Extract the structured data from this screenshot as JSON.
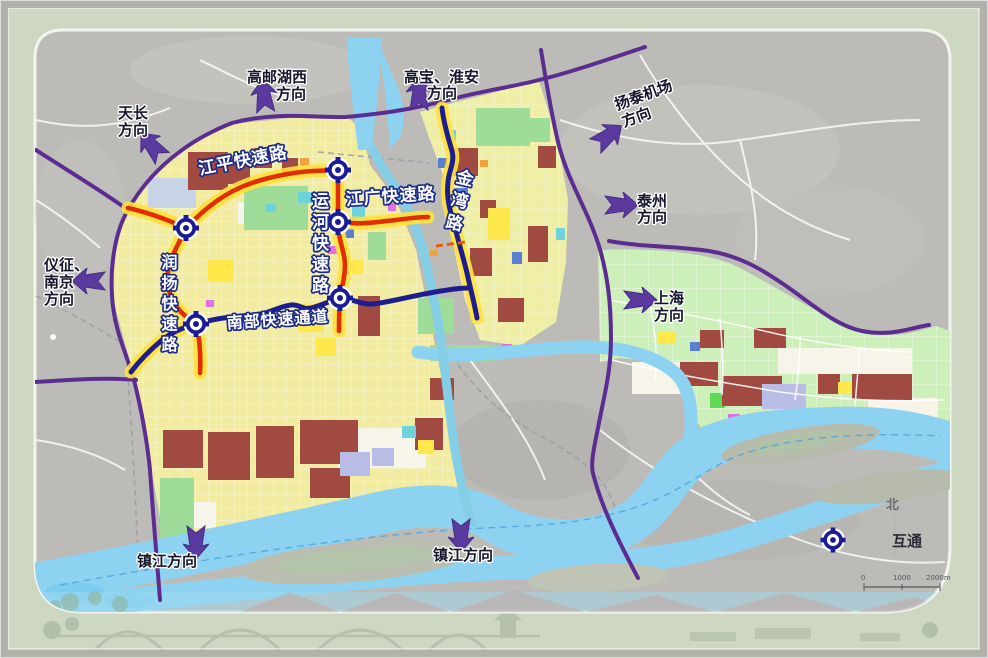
{
  "colors": {
    "frame_bg": "#cdd7c2",
    "map_rural_gray": "#bdbbb7",
    "city_base_yellow": "#f1eca2",
    "southeast_green_zone": "#cdf0ba",
    "water_blue": "#8ed2f2",
    "expressway_purple": "#5c2d91",
    "trunk_road_navy": "#1d1d8f",
    "expressway_red": "#e22d00",
    "road_halo_yellow": "#ffe23e",
    "interchange_blue": "#1b1b96",
    "arrow_purple": "#5b3aa0"
  },
  "roads": {
    "jiangping": "江平快速路",
    "jiangguang": "江广快速路",
    "yunhe": "运河快速路",
    "runyang": "润扬快速路",
    "nanbu": "南部快速通道",
    "jinwan": "金湾路"
  },
  "directions": [
    {
      "id": "tianchang",
      "lines": [
        "天长",
        "方向"
      ]
    },
    {
      "id": "gaoyou-huxi",
      "lines": [
        "高邮湖西",
        "方向"
      ]
    },
    {
      "id": "gaobao-huaian",
      "lines": [
        "高宝、淮安",
        "方向"
      ]
    },
    {
      "id": "yangtai-airport",
      "lines": [
        "扬泰机场",
        "方向"
      ]
    },
    {
      "id": "taizhou",
      "lines": [
        "泰州",
        "方向"
      ]
    },
    {
      "id": "shanghai",
      "lines": [
        "上海",
        "方向"
      ]
    },
    {
      "id": "yizheng-nanjing",
      "lines": [
        "仪征、",
        "南京",
        "方向"
      ]
    },
    {
      "id": "zhenjiang-west",
      "lines": [
        "镇江方向"
      ]
    },
    {
      "id": "zhenjiang-east",
      "lines": [
        "镇江方向"
      ]
    }
  ],
  "legend": {
    "interchange_label": "互通",
    "north_label": "北",
    "scale_labels": [
      "0",
      "1000",
      "2000m"
    ]
  }
}
